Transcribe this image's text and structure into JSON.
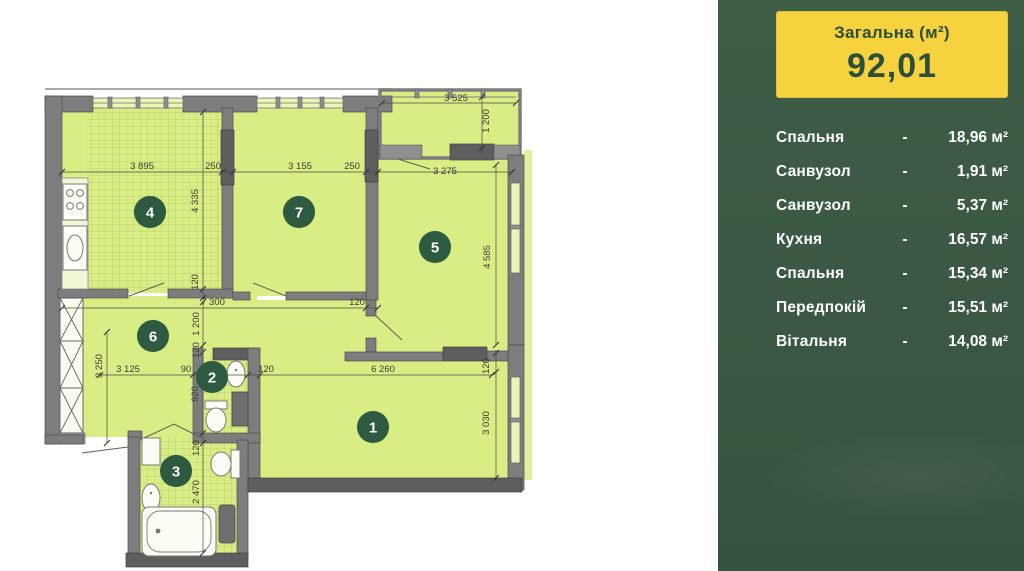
{
  "palette": {
    "sidebar-bg-top": "#3e5d47",
    "sidebar-bg-bottom": "#35523e",
    "box-yellow": "#f6d23f",
    "box-text": "#2c4e3a",
    "room-fill": "#d8ee84",
    "glass-fill": "#eaf6b8",
    "wall-gray": "#7d7d7d",
    "wall-dark": "#5e5e5e",
    "badge-green": "#2d5a41",
    "dim-text": "#3b3b3b",
    "list-text": "#ffffff"
  },
  "sidebar": {
    "total_box": {
      "label": "Загальна (м²)",
      "value": "92,01"
    },
    "rooms": [
      {
        "name": "Спальня",
        "dash": "-",
        "area": "18,96 м²"
      },
      {
        "name": "Санвузол",
        "dash": "-",
        "area": "1,91 м²"
      },
      {
        "name": "Санвузол",
        "dash": "-",
        "area": "5,37 м²"
      },
      {
        "name": "Кухня",
        "dash": "-",
        "area": "16,57 м²"
      },
      {
        "name": "Спальня",
        "dash": "-",
        "area": "15,34 м²"
      },
      {
        "name": "Передпокій",
        "dash": "-",
        "area": "15,51 м²"
      },
      {
        "name": "Вітальня",
        "dash": "-",
        "area": "14,08 м²"
      }
    ]
  },
  "plan": {
    "room_badges": [
      {
        "number": "1",
        "x": 373,
        "y": 427
      },
      {
        "number": "2",
        "x": 212,
        "y": 377
      },
      {
        "number": "3",
        "x": 176,
        "y": 471
      },
      {
        "number": "4",
        "x": 150,
        "y": 212
      },
      {
        "number": "5",
        "x": 435,
        "y": 247
      },
      {
        "number": "6",
        "x": 153,
        "y": 336
      },
      {
        "number": "7",
        "x": 299,
        "y": 212
      }
    ],
    "dims": [
      {
        "text": "3 895",
        "x": 142,
        "y": 169,
        "rot": 0
      },
      {
        "text": "250",
        "x": 213,
        "y": 169,
        "rot": 0
      },
      {
        "text": "3 155",
        "x": 300,
        "y": 169,
        "rot": 0
      },
      {
        "text": "250",
        "x": 352,
        "y": 169,
        "rot": 0
      },
      {
        "text": "3 275",
        "x": 445,
        "y": 174,
        "rot": 0
      },
      {
        "text": "3 525",
        "x": 456,
        "y": 101,
        "rot": 0
      },
      {
        "text": "1 200",
        "x": 489,
        "y": 121,
        "rot": -90
      },
      {
        "text": "4 335",
        "x": 198,
        "y": 201,
        "rot": -90
      },
      {
        "text": "120",
        "x": 198,
        "y": 282,
        "rot": -90
      },
      {
        "text": "4 585",
        "x": 490,
        "y": 257,
        "rot": -90
      },
      {
        "text": "7 300",
        "x": 213,
        "y": 305,
        "rot": 0
      },
      {
        "text": "120",
        "x": 357,
        "y": 305,
        "rot": 0
      },
      {
        "text": "1 200",
        "x": 199,
        "y": 324,
        "rot": -90
      },
      {
        "text": "120",
        "x": 199,
        "y": 350,
        "rot": -90
      },
      {
        "text": "3 250",
        "x": 102,
        "y": 366,
        "rot": -90
      },
      {
        "text": "3 125",
        "x": 128,
        "y": 372,
        "rot": 0
      },
      {
        "text": "90",
        "x": 186,
        "y": 372,
        "rot": 0
      },
      {
        "text": "120",
        "x": 266,
        "y": 372,
        "rot": 0
      },
      {
        "text": "6 260",
        "x": 383,
        "y": 372,
        "rot": 0
      },
      {
        "text": "120",
        "x": 489,
        "y": 366,
        "rot": -90
      },
      {
        "text": "3 030",
        "x": 489,
        "y": 423,
        "rot": -90
      },
      {
        "text": "920",
        "x": 198,
        "y": 394,
        "rot": -90
      },
      {
        "text": "120",
        "x": 199,
        "y": 448,
        "rot": -90
      },
      {
        "text": "2 470",
        "x": 199,
        "y": 492,
        "rot": -90
      }
    ]
  }
}
